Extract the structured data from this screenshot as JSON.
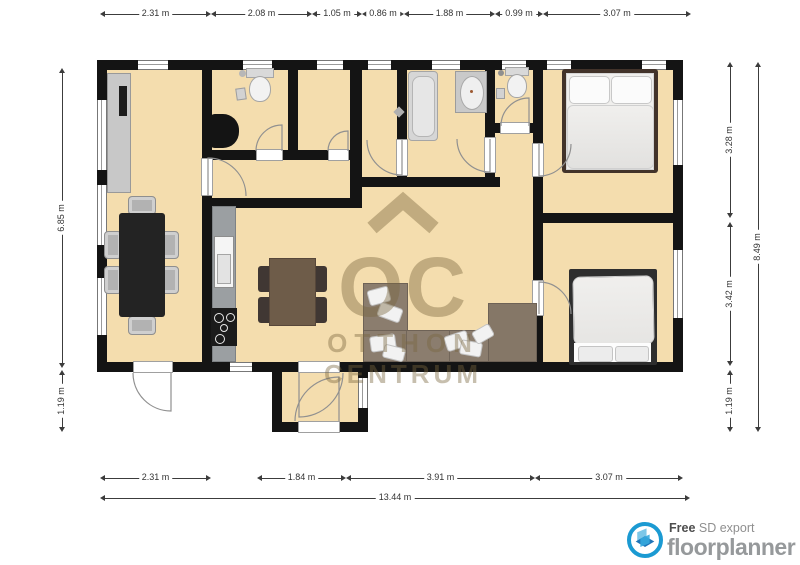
{
  "floorplan": {
    "dimensions": {
      "top": [
        "2.31 m",
        "2.08 m",
        "1.05 m",
        "0.86 m",
        "1.88 m",
        "0.99 m",
        "3.07 m"
      ],
      "bottom": [
        "2.31 m",
        "1.84 m",
        "3.91 m",
        "3.07 m"
      ],
      "bottom_total": "13.44 m",
      "left": [
        "6.85 m",
        "1.19 m"
      ],
      "right_inner": [
        "3.28 m",
        "3.42 m",
        "1.19 m"
      ],
      "right_total": "8.49 m"
    },
    "watermark": {
      "monogram": "OC",
      "line1": "OTTHON",
      "line2": "CENTRUM"
    },
    "colors": {
      "floor": "#f4ddae",
      "wall": "#141414",
      "watermark": "#7a663e",
      "logo_blue": "#1b9ad2"
    }
  },
  "footer": {
    "free": "Free",
    "sd_export": " SD export",
    "brand": "floorplanner"
  }
}
